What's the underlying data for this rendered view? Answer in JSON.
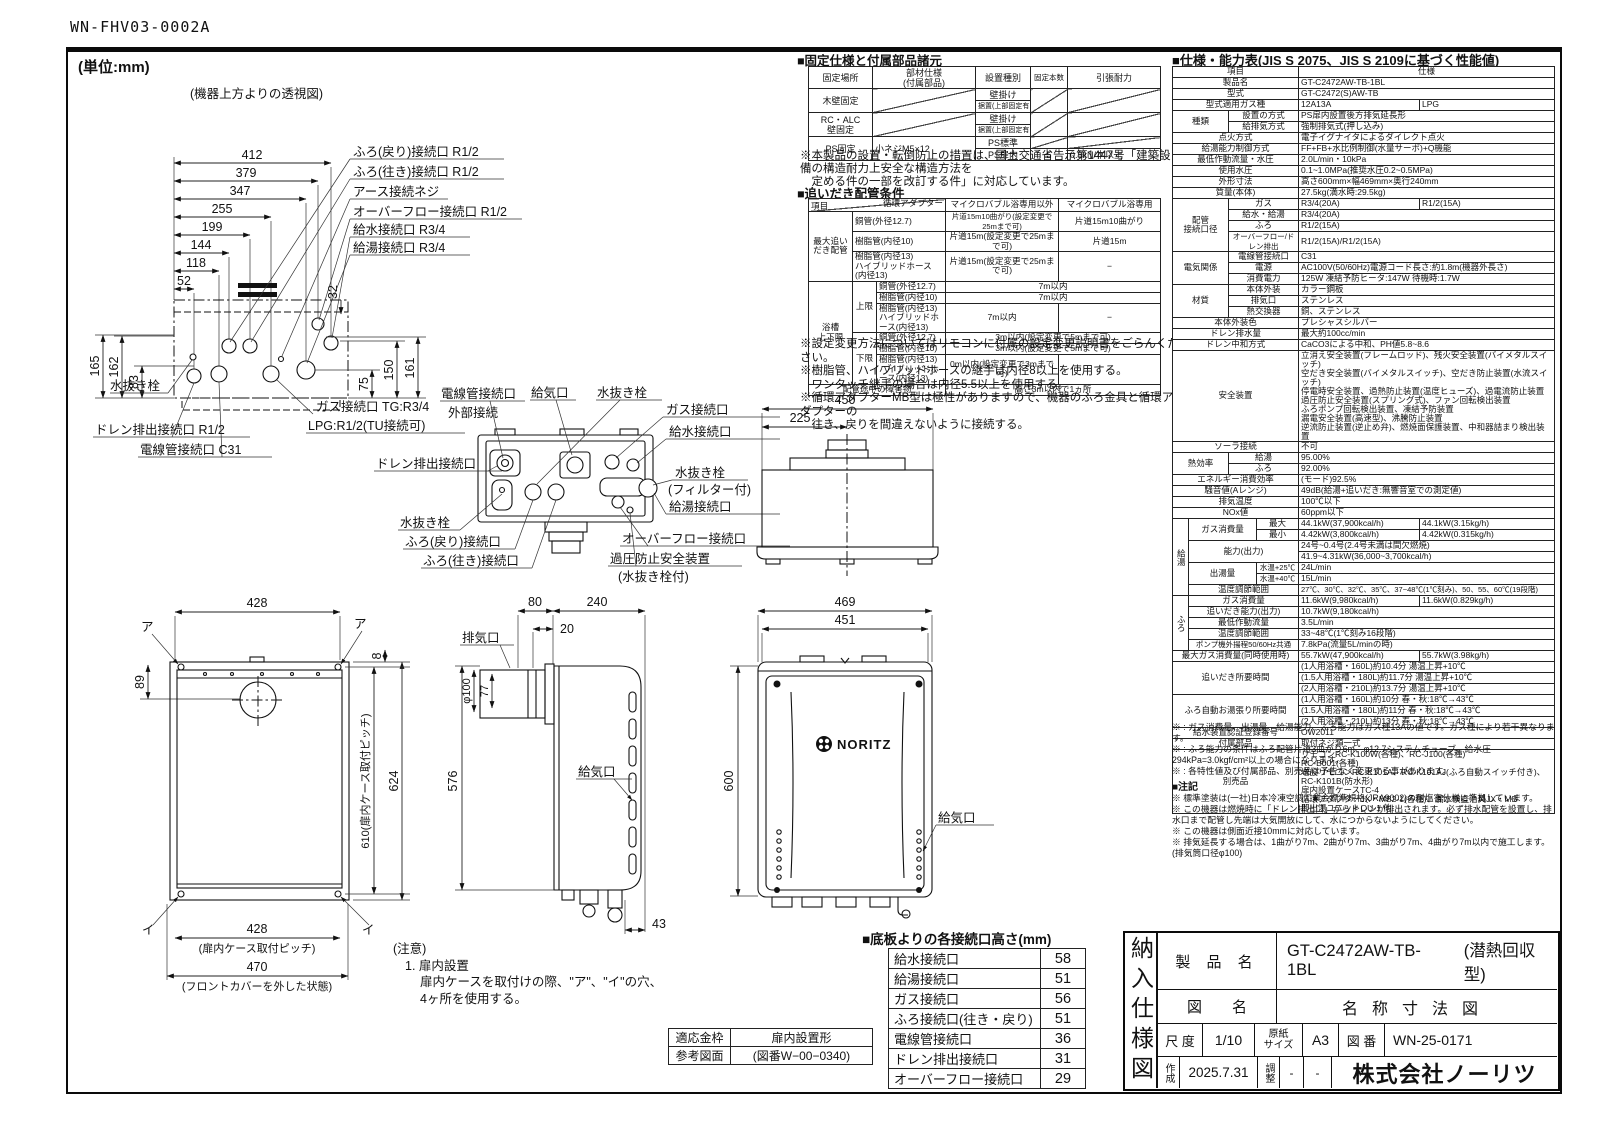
{
  "colors": {
    "ink": "#111111",
    "paper": "#ffffff"
  },
  "sheet_code": "WN-FHV03-0002A",
  "unit_note": "(単位:mm)",
  "top_view": {
    "caption": "(機器上方よりの透視図)",
    "dims_h": [
      "412",
      "379",
      "347",
      "255",
      "199",
      "144",
      "118",
      "52"
    ],
    "dim_32": "32",
    "dims_left": [
      "165",
      "162",
      "83"
    ],
    "dims_right": [
      "75",
      "150",
      "161"
    ],
    "labels": {
      "furo_return": "ふろ(戻り)接続口 R1/2",
      "furo_go": "ふろ(往き)接続口 R1/2",
      "earth": "アース接続ネジ",
      "overflow": "オーバーフロー接続口 R1/2",
      "water_in": "給水接続口 R3/4",
      "hot_out": "給湯接続口 R3/4",
      "drain_plug": "水抜き栓",
      "drain_out": "ドレン排出接続口 R1/2",
      "conduit": "電線管接続口 C31",
      "gas1": "ガス接続口 TG:R3/4",
      "gas2": "LPG:R1/2(TU接続可)"
    }
  },
  "bottom_view": {
    "labels": {
      "conduit": "電線管接続口",
      "external": "外部接続",
      "intake": "給気口",
      "drain_plug": "水抜き栓",
      "gas": "ガス接続口",
      "water_in": "給水接続口",
      "drain_plug2": "水抜き栓",
      "filter": "(フィルター付)",
      "hot_out": "給湯接続口",
      "overflow": "オーバーフロー接続口",
      "relief": "過圧防止安全装置",
      "relief2": "(水抜き栓付)",
      "drain_out": "ドレン排出接続口",
      "drain_plug3": "水抜き栓",
      "furo_return": "ふろ(戻り)接続口",
      "furo_go": "ふろ(往き)接続口"
    }
  },
  "plan_view": {
    "dim_450": "450",
    "dim_225": "225"
  },
  "front_open": {
    "dim_428_top": "428",
    "a": "ア",
    "i": "イ",
    "dim_8": "8",
    "dim_89": "89",
    "dim_610": "610(扉内ケース取付ピッチ)",
    "dim_624": "624",
    "dim_428_bottom": "428",
    "pitch_note": "(扉内ケース取付ピッチ)",
    "dim_470": "470",
    "cover_note": "(フロントカバーを外した状態)"
  },
  "side_view": {
    "dim_80": "80",
    "dim_240": "240",
    "dim_20": "20",
    "exhaust": "排気口",
    "dia_100": "φ100",
    "dim_77": "77",
    "dim_576": "576",
    "intake": "給気口",
    "dim_43": "43"
  },
  "front_view": {
    "dim_469": "469",
    "dim_451": "451",
    "dim_600": "600",
    "logo": "NORITZ",
    "intake": "給気口"
  },
  "caution": {
    "l1": "(注意)",
    "l2": "1. 扉内設置",
    "l3": "扉内ケースを取付けの際、\"ア\"、\"イ\"の穴、",
    "l4": "4ヶ所を使用する。"
  },
  "fixing_table": {
    "title": "■固定仕様と付属部品諸元",
    "col_place": "固定場所",
    "col_part": "部材仕様\n(付属部品)",
    "col_type": "設置種別",
    "col_count": "固定本数",
    "col_strength": "引張耐力",
    "wood_l": "木壁固定",
    "rc_l": "RC・ALC\n壁固定",
    "ps_l": "PS固定",
    "ps_part": "小ネジM5×12",
    "type_wall": "壁掛け",
    "type_floor": "据置(上部固定有り)",
    "type_ps_std": "PS標準",
    "type_ps_in": "PS扉内",
    "ps_count": "5",
    "ps_strength": "0.5kN/本以上",
    "note1": "※本製品の設置・転倒防止の措置は、国土交通省告示第1447号「建築設備の構造耐力上安全な構造方法を",
    "note2": "　定める件の一部を改訂する件」に対応しています。"
  },
  "reheat_table": {
    "title": "■追いだき配管条件",
    "hd_item": "項目",
    "hd_adapter": "循環アダプター",
    "hd_nonmicro": "マイクロバブル浴専用以外",
    "hd_micro": "マイクロバブル浴専用",
    "grp_max": "最大追い\nだき配管",
    "grp_bath": "浴槽\n上下限",
    "sub_upper": "上限",
    "sub_lower": "下限",
    "pipe_cu": "銅管(外径12.7)",
    "pipe_r10": "樹脂管(内径10)",
    "pipe_r13": "樹脂管(内径13)\nハイブリッドホース(内径13)",
    "v_cu_non": "片道15m10曲がり(設定変更で25mまで可)",
    "v_cu_mic": "片道15m10曲がり",
    "v_r10_non": "片道15m(設定変更で25mまで可)",
    "v_r10_mic": "片道15m",
    "v_r13_non": "片道15m(設定変更で25mまで可)",
    "dash": "−",
    "v_up": "7m以内",
    "v_low": "3m以内(設定変更で5mまで可)",
    "v_low13": "0m以内(設定変更で3mまで可)",
    "obstacle_l": "配管途中の障害物",
    "obstacle_v": "高さ3m以内で1ヵ所",
    "notes": [
      "※設定変更方法についてはリモコンに付属の設定変更説明書をごらんください。",
      "※樹脂管、ハイブリッドホースの継手は内径8以上を使用する。",
      "　ワンタッチ継手の場合は内径5.5以上を使用する。",
      "※循環アダプターMB型は極性がありますので、機器のふろ金具と循環アダプターの",
      "　往き、戻りを間違えないように接続する。"
    ]
  },
  "heights_table": {
    "title": "■底板よりの各接続口高さ(mm)",
    "rows": [
      {
        "label": "給水接続口",
        "value": "58"
      },
      {
        "label": "給湯接続口",
        "value": "51"
      },
      {
        "label": "ガス接続口",
        "value": "56"
      },
      {
        "label": "ふろ接続口(往き・戻り)",
        "value": "51"
      },
      {
        "label": "電線管接続口",
        "value": "36"
      },
      {
        "label": "ドレン排出接続口",
        "value": "31"
      },
      {
        "label": "オーバーフロー接続口",
        "value": "29"
      }
    ]
  },
  "frame_table": {
    "r1c1": "適応金枠",
    "r1c2": "扉内設置形",
    "r2c1": "参考図面",
    "r2c2": "(図番W−00−0340)"
  },
  "spec_table": {
    "title": "■仕様・能力表(JIS S 2075、JIS S 2109に基づく性能値)",
    "col_item": "項目",
    "col_spec": "仕様",
    "rows": {
      "product_l": "製品名",
      "product_v": "GT-C2472AW-TB-1BL",
      "model_l": "型式",
      "model_v": "GT-C2472(S)AW-TB",
      "gastype_l": "型式適用ガス種",
      "gastype_v1": "12A13A",
      "gastype_v2": "LPG",
      "kind_l": "種類",
      "kind_install_l": "設置の方式",
      "kind_install_v": "PS扉内設置後方排気延長形",
      "kind_exhaust_l": "給排気方式",
      "kind_exhaust_v": "強制排気式(押し込み)",
      "ignition_l": "点火方式",
      "ignition_v": "電子イグナイタによるダイレクト点火",
      "control_l": "給湯能力制御方式",
      "control_v": "FF+FB+水比例制御(水量サーボ)+Q機能",
      "minflow_l": "最低作動流量・水圧",
      "minflow_v": "2.0L/min・10kPa",
      "pressure_l": "使用水圧",
      "pressure_v": "0.1~1.0MPa(推奨水圧0.2~0.5MPa)",
      "size_l": "外形寸法",
      "size_v": "高さ600mm×幅469mm×奥行240mm",
      "weight_l": "質量(本体)",
      "weight_v": "27.5kg(満水時:29.5kg)",
      "pipe_l": "配管\n接続口径",
      "pipe_gas_l": "ガス",
      "pipe_gas_v1": "R3/4(20A)",
      "pipe_gas_v2": "R1/2(15A)",
      "pipe_water_l": "給水・給湯",
      "pipe_water_v": "R3/4(20A)",
      "pipe_furo_l": "ふろ",
      "pipe_furo_v": "R1/2(15A)",
      "pipe_of_l": "オーバーフロー/ドレン排出",
      "pipe_of_v": "R1/2(15A)/R1/2(15A)",
      "elec_l": "電気関係",
      "elec_conduit_l": "電線管接続口",
      "elec_conduit_v": "C31",
      "elec_power_l": "電源",
      "elec_power_v": "AC100V(50/60Hz)電源コード長さ:約1.8m(機器外長さ)",
      "elec_consumption_l": "消費電力",
      "elec_consumption_v": "125W 凍結予防ヒータ:147W 待機時:1.7W",
      "material_l": "材質",
      "mat_body_l": "本体外装",
      "mat_body_v": "カラー鋼板",
      "mat_exhaust_l": "排気口",
      "mat_exhaust_v": "ステンレス",
      "mat_hex_l": "熱交換器",
      "mat_hex_v": "銅、ステンレス",
      "color_l": "本体外装色",
      "color_v": "プレシャスシルバー",
      "drain_l": "ドレン排水量",
      "drain_v": "最大約100cc/min",
      "neutral_l": "ドレン中和方式",
      "neutral_v": "CaCO3による中和、PH値5.8~8.6",
      "safety_l": "安全装置",
      "safety_v": "立消え安全装置(フレームロッド)、残火安全装置(バイメタルスイッチ)\n空だき安全装置(バイメタルスイッチ)、空だき防止装置(水流スイッチ)\n停電時安全装置、過熱防止装置(温度ヒューズ)、過電流防止装置\n過圧防止安全装置(スプリング式)、ファン回転検出装置\nふろポンプ回転検出装置、凍結予防装置\n漏電安全装置(高速型)、沸騰防止装置\n逆流防止装置(逆止め弁)、燃焼面保護装置、中和器詰まり検出装置",
      "solar_l": "ソーラ接続",
      "solar_v": "不可",
      "eff_l": "熱効率",
      "eff_hw_l": "給湯",
      "eff_hw_v": "95.00%",
      "eff_furo_l": "ふろ",
      "eff_furo_v": "92.00%",
      "energy_l": "エネルギー消費効率",
      "energy_v": "(モード)92.5%",
      "noise_l": "騒音値(Aレンジ)",
      "noise_v": "49dB(給湯+追いだき:無響音室での測定値)",
      "exh_temp_l": "排気温度",
      "exh_temp_v": "100℃以下",
      "nox_l": "NOx値",
      "nox_v": "60ppm以下",
      "hw_group": "給湯",
      "hw_gas_l": "ガス消費量",
      "hw_gas_max_l": "最大",
      "hw_gas_max_v1": "44.1kW(37,900kcal/h)",
      "hw_gas_max_v2": "44.1kW(3.15kg/h)",
      "hw_gas_min_l": "最小",
      "hw_gas_min_v1": "4.42kW(3,800kcal/h)",
      "hw_gas_min_v2": "4.42kW(0.315kg/h)",
      "hw_cap_l": "能力(出力)",
      "hw_cap_v1": "24号~0.4号(2.4号未満は間欠燃焼)",
      "hw_cap_v2": "41.9~4.31kW(36,000~3,700kcal/h)",
      "hw_flow_l": "出湯量",
      "hw_flow25_l": "水温+25℃",
      "hw_flow25_v": "24L/min",
      "hw_flow40_l": "水温+40℃",
      "hw_flow40_v": "15L/min",
      "hw_temp_l": "温度調節範囲",
      "hw_temp_v": "27℃、30℃、32℃、35℃、37~48℃(1℃刻み)、50、55、60℃(19段階)",
      "furo_group": "ふろ",
      "furo_gas_l": "ガス消費量",
      "furo_gas_v1": "11.6kW(9,980kcal/h)",
      "furo_gas_v2": "11.6kW(0.829kg/h)",
      "furo_cap_l": "追いだき能力(出力)",
      "furo_cap_v": "10.7kW(9,180kcal/h)",
      "furo_minflow_l": "最低作動流量",
      "furo_minflow_v": "3.5L/min",
      "furo_temp_l": "温度調節範囲",
      "furo_temp_v": "33~48℃(1℃刻み16段階)",
      "pump_l": "ポンプ機外揚程50/60Hz共通",
      "pump_v": "7.8kPa(流量5L/minの時)",
      "maxgas_l": "最大ガス消費量(同時使用時)",
      "maxgas_v1": "55.7kW(47,900kcal/h)",
      "maxgas_v2": "55.7kW(3.98kg/h)",
      "reheat_l": "追いだき所要時間",
      "reheat_v1": "(1人用浴槽・160L)約10.4分 湯温上昇+10℃",
      "reheat_v2": "(1.5人用浴槽・180L)約11.7分 湯温上昇+10℃",
      "reheat_v3": "(2人用浴槽・210L)約13.7分 湯温上昇+10℃",
      "autofill_l": "ふろ自動お湯張り所要時間",
      "autofill_v1": "(1人用浴槽・160L)約10分 春・秋:18℃→43℃",
      "autofill_v2": "(1.5人用浴槽・180L)約11分 春・秋:18℃→43℃",
      "autofill_v3": "(2人用浴槽・210L)約13分 春・秋:18℃→43℃",
      "cert_l": "給水装置認証登録番号",
      "cert_v": "OW2011",
      "accessories_l": "付属部品",
      "accessories_v": "取付ネジ類一式",
      "optional_l": "別売品",
      "optional_v": "リモコンRC-K100W(各種)、RC-J100(各種)\nRC-B001(各種)\n増設リモコンRC-K101A、RC-K101AJ(ふろ自動スイッチ付き)、RC-K101B(防水形)\n扉内設置ケースTC-4\n循環アダプターJX・MB2-1(各種)、漏水検査治具JX・MB\n即出湯ユニットQU-1 他"
    }
  },
  "spec_notes": [
    "※ : ガス消費量、出湯量、給湯能力、ふろ能力はガス種13Aの値です。ガス種により若干異なります。",
    "※ : ふろ能力の条件はふろ配管片道3曲がり6m、φ12.7システムチューブ、給水圧294kPa=3.0kgf/cm²以上の場合になります。",
    "※ : 各特性値及び付属部品、別売品は予告なく変更する事があります。"
  ],
  "notes_title": "■注記",
  "notes": [
    "※ 標準塗装は(一社)日本冷凍空調工業会標準規格(JRA9002)の耐塩害仕様に準拠しています。",
    "※ この機器は燃焼時に「ドレン排出口」からドレンが排出されます。必ず排水配管を設置し、排水口まで配管し先端は大気開放にして、水につからないようにしてください。",
    "※ この機器は側面近接10mmに対応しています。",
    "※ 排気延長する場合は、1曲がり7m、2曲がり7m、3曲がり7m、4曲がり7m以内で施工します。(排気筒口径φ100)"
  ],
  "title_block": {
    "vertical_title": "納入仕様図",
    "product_label": "製 品 名",
    "product_value": "GT-C2472AW-TB-1BL",
    "product_note": "(潜熱回収型)",
    "drawing_label": "図　　名",
    "drawing_value": "名称寸法図",
    "scale_label": "尺 度",
    "scale_value": "1/10",
    "paper_label": "原紙\nサイズ",
    "paper_value": "A3",
    "number_label": "図 番",
    "number_value": "WN-25-0171",
    "created_label": "作成",
    "created_value": "2025.7.31",
    "adjust_label": "調整",
    "adjust_v1": "-",
    "adjust_v2": "-",
    "company": "株式会社ノーリツ"
  }
}
